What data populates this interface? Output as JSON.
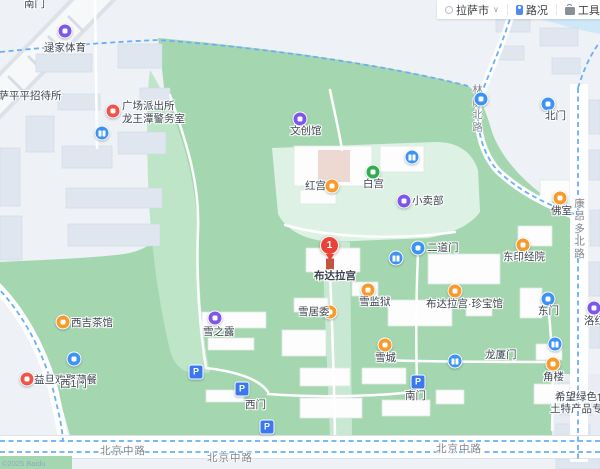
{
  "toolbar": {
    "city": "拉萨市",
    "traffic_label": "路况",
    "tools_label": "工具"
  },
  "map": {
    "main_pin": {
      "number": "1",
      "label": "布达拉宫"
    },
    "copyright": "©2025 Baidu",
    "colors": {
      "park_green": "#a4d7b0",
      "palace_ground": "#def1e5",
      "urban": "#eef1f5",
      "water": "#cfe8f8",
      "poi_orange": "#f79b2c",
      "poi_purple": "#7e57e8",
      "poi_red": "#ef5349",
      "poi_blue": "#3d93f2",
      "poi_green": "#2fae4f",
      "pin_red": "#e9443a",
      "route_dash_blue": "#6aaef8"
    },
    "pois": [
      {
        "name": "gate-nanmen-north",
        "type": "text",
        "label": "南门",
        "lx": 24,
        "ly": -2
      },
      {
        "name": "lujia-sports",
        "type": "shop",
        "x": 65,
        "y": 31,
        "label": "逯家体育",
        "lx": 44,
        "ly": 42
      },
      {
        "name": "pingping-hostel",
        "type": "text",
        "label": "拉萨平平招待所",
        "lx": -12,
        "ly": 90
      },
      {
        "name": "guangchang-police-station",
        "type": "police",
        "x": 113,
        "y": 111,
        "label": "广场派出所",
        "lx": 122,
        "ly": 100,
        "label2": "龙王潭警务室",
        "l2x": 122,
        "l2y": 113
      },
      {
        "name": "toilet-northwest",
        "type": "toilet",
        "x": 102,
        "y": 133
      },
      {
        "name": "wenchuang-hall",
        "type": "shop",
        "x": 300,
        "y": 119,
        "label": "文创馆",
        "lx": 290,
        "ly": 125
      },
      {
        "name": "red-palace",
        "type": "attraction",
        "x": 332,
        "y": 186,
        "label": "红宫",
        "lx": 305,
        "ly": 180
      },
      {
        "name": "white-palace",
        "type": "palace",
        "x": 373,
        "y": 172,
        "label": "白宫",
        "lx": 363,
        "ly": 178
      },
      {
        "name": "toilet-north",
        "type": "toilet",
        "x": 412,
        "y": 157
      },
      {
        "name": "poi-dot-north-road",
        "type": "dot",
        "x": 481,
        "y": 99
      },
      {
        "name": "gate-beimen",
        "type": "gate",
        "x": 548,
        "y": 104,
        "label": "北门",
        "lx": 545,
        "ly": 110
      },
      {
        "name": "xiaomaibu-kiosk",
        "type": "shop",
        "x": 404,
        "y": 201,
        "label": "小卖部",
        "lx": 412,
        "ly": 195
      },
      {
        "name": "foshi-buddha-hall",
        "type": "attraction",
        "x": 560,
        "y": 198,
        "label": "佛室",
        "lx": 551,
        "ly": 205
      },
      {
        "name": "dong-scripture-house",
        "type": "attraction",
        "x": 523,
        "y": 245,
        "label": "东印经院",
        "lx": 503,
        "ly": 251
      },
      {
        "name": "gate-erdaomen",
        "type": "gate",
        "x": 418,
        "y": 248,
        "label": "二道门",
        "lx": 427,
        "ly": 242
      },
      {
        "name": "toilet-center",
        "type": "toilet",
        "x": 396,
        "y": 258
      },
      {
        "name": "treasure-museum",
        "type": "attraction",
        "x": 455,
        "y": 291,
        "label": "布达拉宫·珍宝馆",
        "lx": 426,
        "ly": 298
      },
      {
        "name": "snow-prison",
        "type": "attraction",
        "x": 368,
        "y": 290,
        "label": "雪监狱",
        "lx": 359,
        "ly": 296
      },
      {
        "name": "snow-committee",
        "type": "attraction",
        "x": 330,
        "y": 312,
        "label": "雪居委",
        "lx": 298,
        "ly": 306
      },
      {
        "name": "xuezhilu-shop",
        "type": "shop",
        "x": 215,
        "y": 318,
        "label": "雪之露",
        "lx": 203,
        "ly": 326
      },
      {
        "name": "xiji-teahouse",
        "type": "attraction",
        "x": 63,
        "y": 322,
        "label": "西吉茶馆",
        "lx": 71,
        "ly": 317
      },
      {
        "name": "yidan-restaurant",
        "type": "food",
        "x": 27,
        "y": 379,
        "label": "益旦欢聚藏餐",
        "lx": 34,
        "ly": 374
      },
      {
        "name": "gate-xi1men",
        "type": "gate",
        "x": 74,
        "y": 359,
        "label": "西1门",
        "lx": 60,
        "ly": 378
      },
      {
        "name": "parking-west-1",
        "type": "parking",
        "x": 196,
        "y": 372,
        "glyph": "P"
      },
      {
        "name": "parking-west-2",
        "type": "parking",
        "x": 242,
        "y": 389,
        "glyph": "P"
      },
      {
        "name": "gate-ximen",
        "type": "text",
        "label": "西门",
        "lx": 245,
        "ly": 399
      },
      {
        "name": "parking-south-1",
        "type": "parking",
        "x": 267,
        "y": 427,
        "glyph": "P"
      },
      {
        "name": "snow-city",
        "type": "attraction",
        "x": 385,
        "y": 345,
        "label": "雪城",
        "lx": 375,
        "ly": 352
      },
      {
        "name": "toilet-south",
        "type": "toilet",
        "x": 455,
        "y": 361
      },
      {
        "name": "longsha-gate",
        "type": "text",
        "label": "龙厦门",
        "lx": 485,
        "ly": 349
      },
      {
        "name": "gate-nanmen",
        "type": "parking",
        "x": 418,
        "y": 382,
        "glyph": "P",
        "label": "南门",
        "lx": 405,
        "ly": 390
      },
      {
        "name": "corner-tower",
        "type": "attraction",
        "x": 553,
        "y": 364,
        "label": "角楼",
        "lx": 543,
        "ly": 371
      },
      {
        "name": "toilet-east",
        "type": "toilet",
        "x": 555,
        "y": 344
      },
      {
        "name": "gate-dongmen",
        "type": "gate",
        "x": 548,
        "y": 299,
        "label": "东门",
        "lx": 538,
        "ly": 305
      },
      {
        "name": "luohongtang",
        "type": "shop",
        "x": 594,
        "y": 308,
        "label": "洛红堂",
        "lx": 584,
        "ly": 315
      },
      {
        "name": "greenfood-store",
        "type": "text",
        "label": "希望绿色食品",
        "lx": 555,
        "ly": 391,
        "label2": "土特产品专卖店",
        "l2x": 550,
        "l2y": 403
      }
    ],
    "road_labels": [
      {
        "name": "road-beijing-middle-1",
        "text": "北京中路",
        "x": 100,
        "y": 443,
        "vertical": false
      },
      {
        "name": "road-beijing-middle-2",
        "text": "北京中路",
        "x": 207,
        "y": 450,
        "vertical": false
      },
      {
        "name": "road-beijing-middle-3",
        "text": "北京中路",
        "x": 436,
        "y": 441,
        "vertical": false
      },
      {
        "name": "road-kangangduo-north",
        "text": "康昂多北路",
        "x": 572,
        "y": 198,
        "vertical": true
      },
      {
        "name": "road-linkuo-north",
        "text": "林廓北路",
        "x": 470,
        "y": 84,
        "vertical": true
      }
    ]
  }
}
